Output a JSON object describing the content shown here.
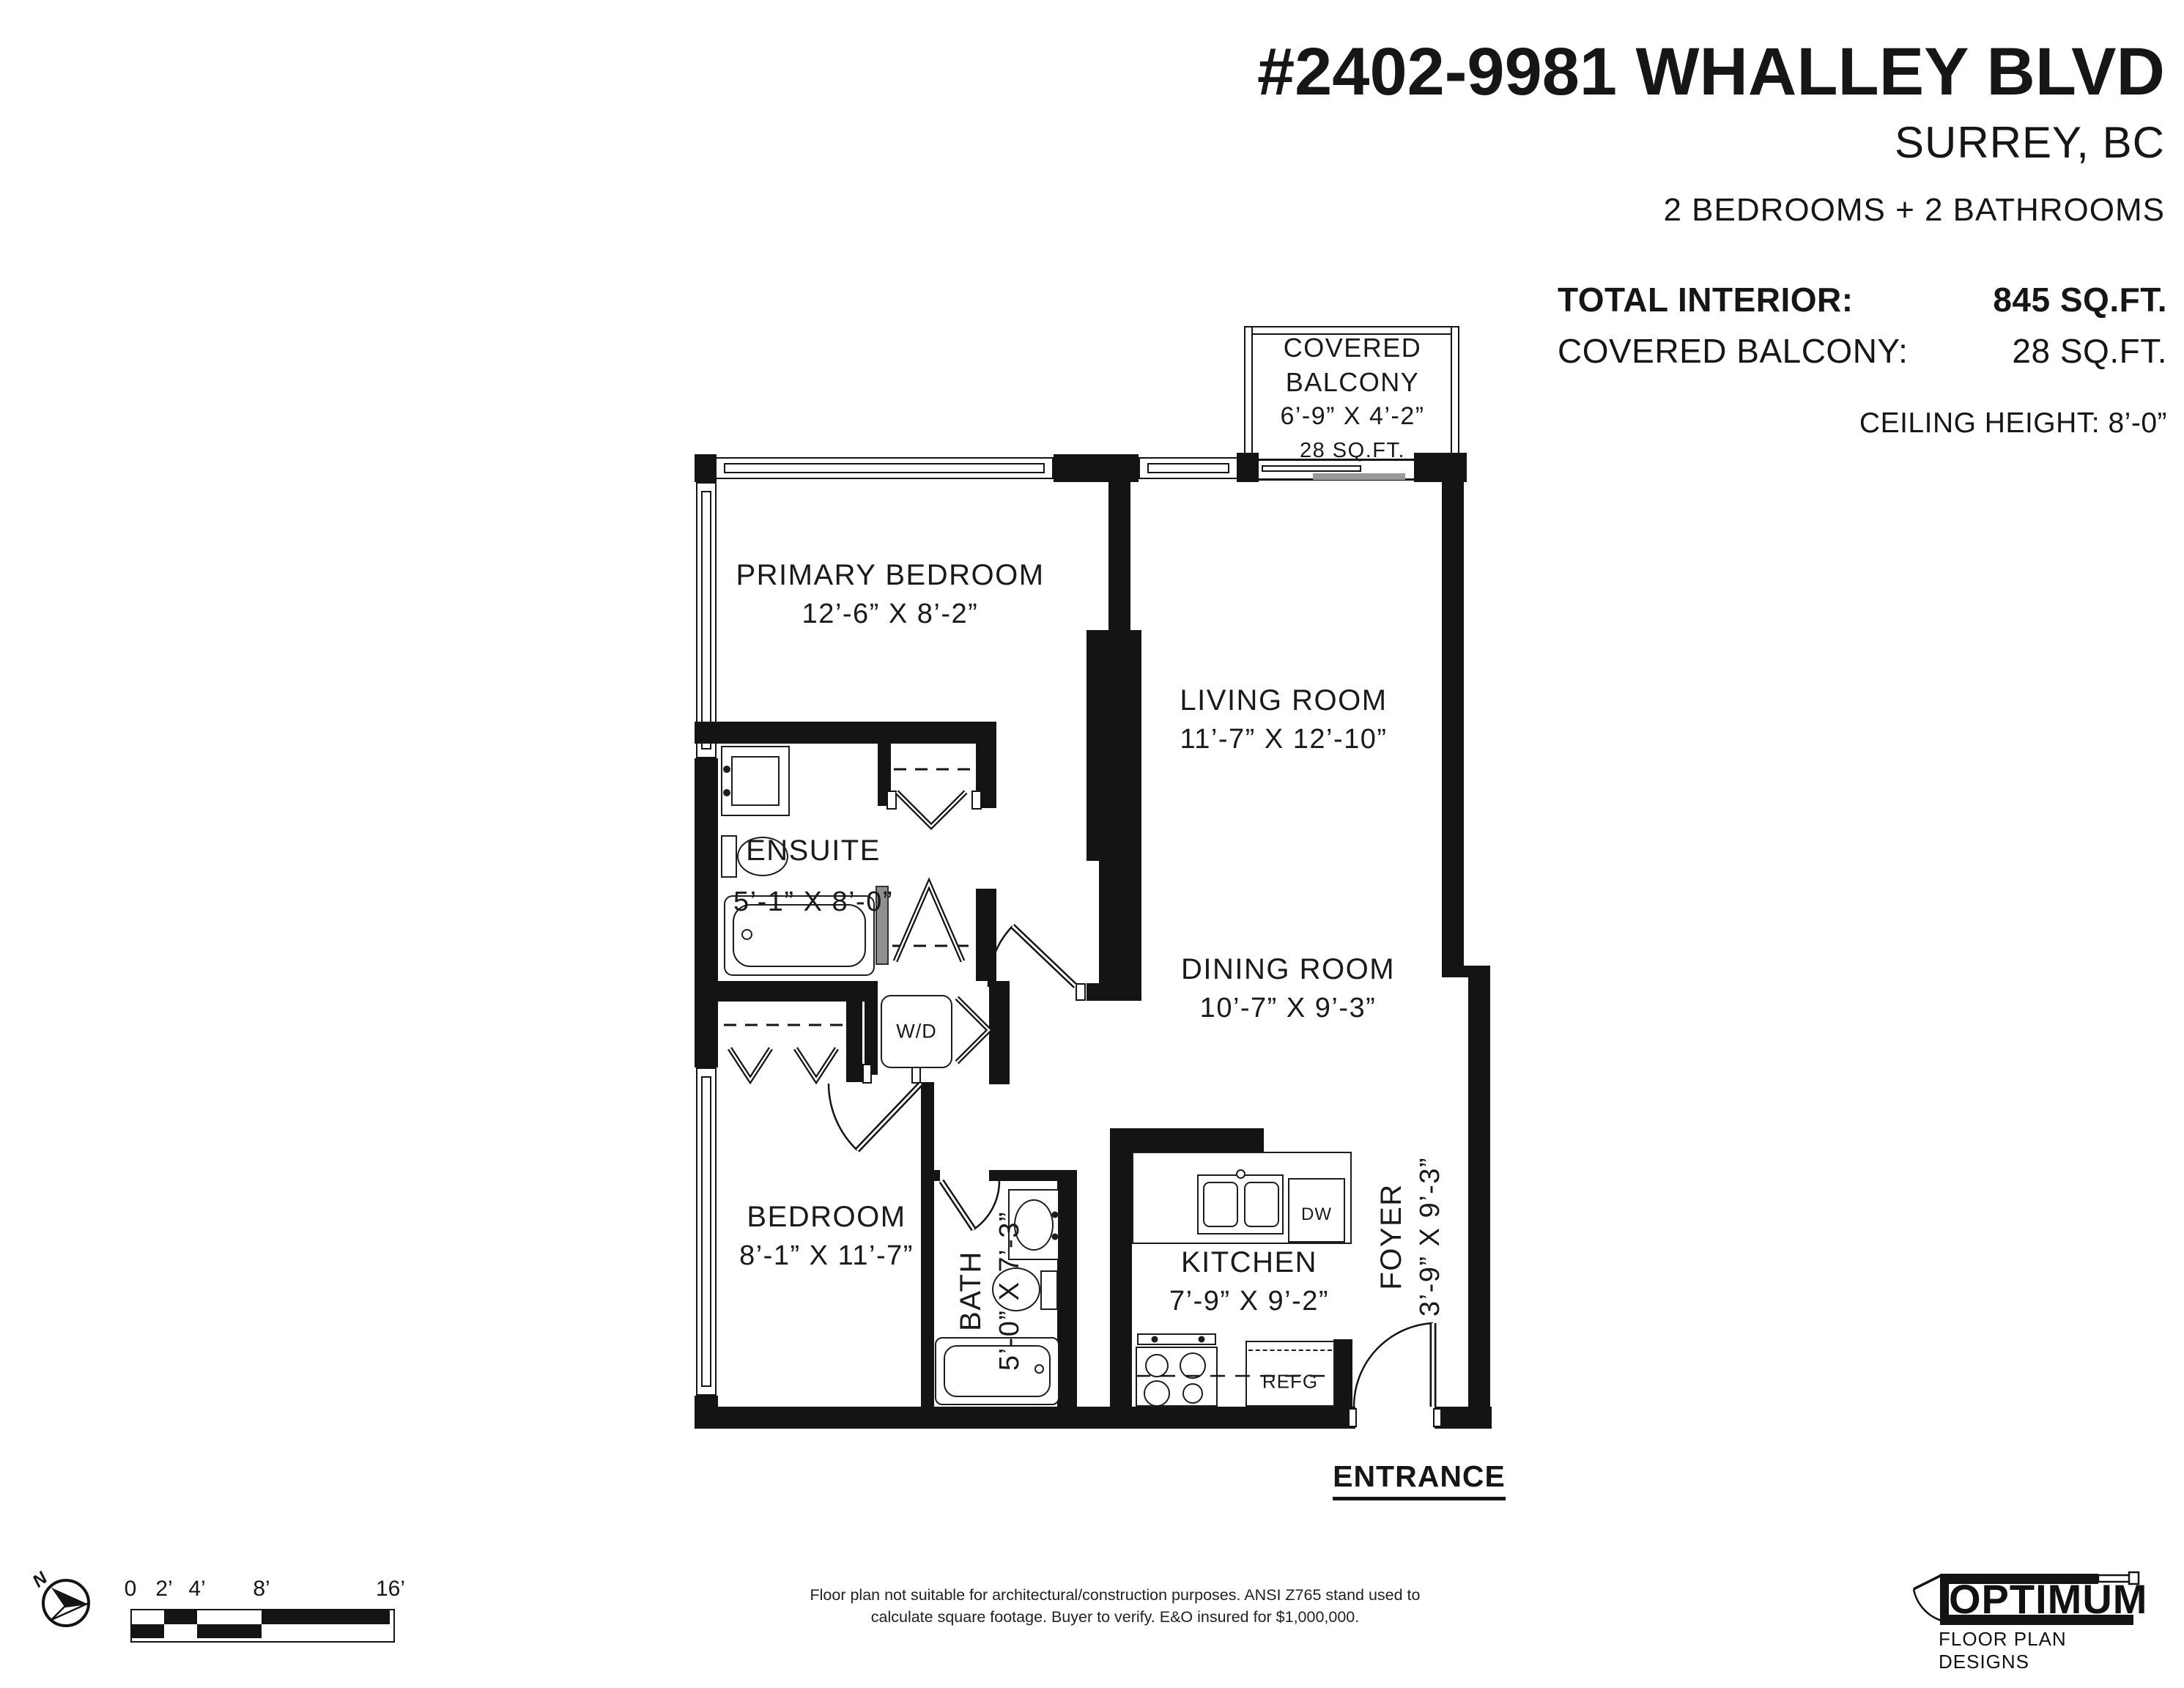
{
  "header": {
    "title": "#2402-9981 WHALLEY BLVD",
    "city": "SURREY, BC",
    "summary": "2 BEDROOMS + 2 BATHROOMS",
    "stat1_label": "TOTAL INTERIOR:",
    "stat1_value": "845 SQ.FT.",
    "stat2_label": "COVERED BALCONY:",
    "stat2_value": "28 SQ.FT.",
    "ceiling": "CEILING HEIGHT: 8’-0”"
  },
  "rooms": {
    "balcony": {
      "line1": "COVERED",
      "line2": "BALCONY",
      "dims": "6’-9” X 4’-2”",
      "area": "28 SQ.FT."
    },
    "primary_bedroom": {
      "name": "PRIMARY BEDROOM",
      "dims": "12’-6” X 8’-2”"
    },
    "living_room": {
      "name": "LIVING ROOM",
      "dims": "11’-7” X 12’-10”"
    },
    "ensuite": {
      "name": "ENSUITE",
      "dims": "5’-1” X 8’-0”"
    },
    "dining_room": {
      "name": "DINING ROOM",
      "dims": "10’-7” X 9’-3”"
    },
    "bedroom": {
      "name": "BEDROOM",
      "dims": "8’-1” X 11’-7”"
    },
    "bath": {
      "name": "BATH",
      "dims": "5’-0” X 7’-3”"
    },
    "kitchen": {
      "name": "KITCHEN",
      "dims": "7’-9” X 9’-2”"
    },
    "foyer": {
      "name": "FOYER",
      "dims": "3’-9” X 9’-3”"
    }
  },
  "fixtures": {
    "washer_dryer": "W/D",
    "dishwasher": "DW",
    "fridge": "REFG"
  },
  "entrance": "ENTRANCE",
  "scale_bar": {
    "ticks": [
      "0",
      "2’",
      "4’",
      "8’",
      "16’"
    ]
  },
  "compass": {
    "north": "N"
  },
  "disclaimer": {
    "line1": "Floor plan not suitable for architectural/construction purposes. ANSI Z765 stand used to",
    "line2": "calculate square footage. Buyer to verify.  E&O insured for $1,000,000."
  },
  "logo": {
    "name": "OPTIMUM",
    "tagline": "FLOOR PLAN DESIGNS"
  }
}
